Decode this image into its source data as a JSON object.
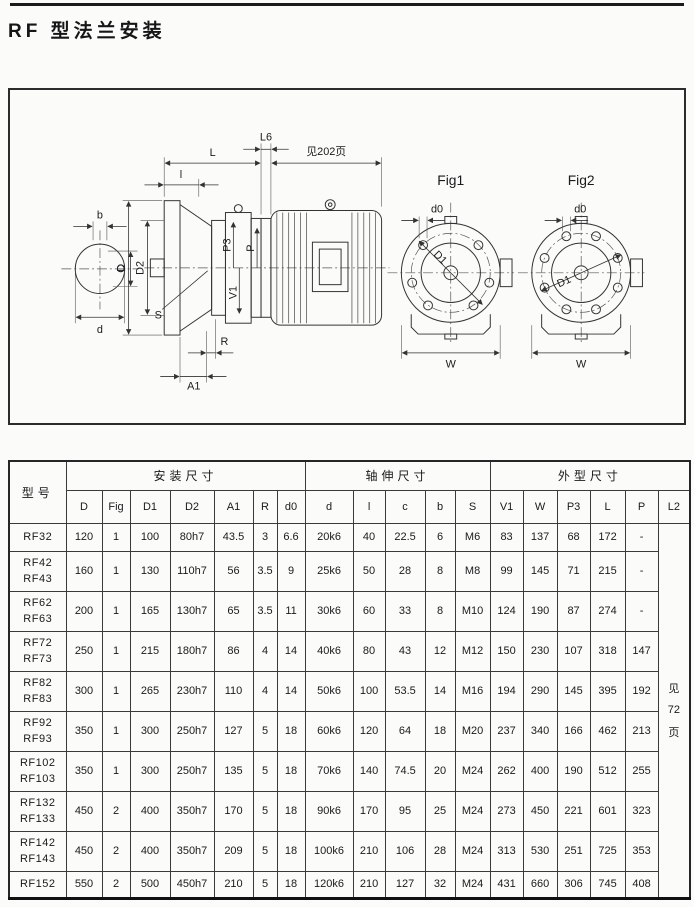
{
  "page": {
    "title": "RF 型法兰安装"
  },
  "drawing": {
    "labels": {
      "b": "b",
      "C": "C",
      "d_small": "d",
      "D": "D",
      "D2": "D2",
      "l_small": "l",
      "L": "L",
      "L6": "L6",
      "see_page": "见202页",
      "P3": "P3",
      "P": "P",
      "V1": "V1",
      "S": "S",
      "R": "R",
      "A1": "A1",
      "fig1": "Fig1",
      "fig2": "Fig2",
      "d0": "d0",
      "D1": "D1",
      "W": "W"
    }
  },
  "table": {
    "model_header": "型号",
    "groups": [
      {
        "label": "安装尺寸"
      },
      {
        "label": "轴伸尺寸"
      },
      {
        "label": "外型尺寸"
      }
    ],
    "columns": [
      "D",
      "Fig",
      "D1",
      "D2",
      "A1",
      "R",
      "d0",
      "d",
      "l",
      "c",
      "b",
      "S",
      "V1",
      "W",
      "P3",
      "L",
      "P",
      "L2"
    ],
    "l2_note_lines": [
      "见",
      "72",
      "页"
    ],
    "rows": [
      {
        "model": [
          "RF32"
        ],
        "values": [
          "120",
          "1",
          "100",
          "80h7",
          "43.5",
          "3",
          "6.6",
          "20k6",
          "40",
          "22.5",
          "6",
          "M6",
          "83",
          "137",
          "68",
          "172",
          "-"
        ]
      },
      {
        "model": [
          "RF42",
          "RF43"
        ],
        "values": [
          "160",
          "1",
          "130",
          "110h7",
          "56",
          "3.5",
          "9",
          "25k6",
          "50",
          "28",
          "8",
          "M8",
          "99",
          "145",
          "71",
          "215",
          "-"
        ]
      },
      {
        "model": [
          "RF62",
          "RF63"
        ],
        "values": [
          "200",
          "1",
          "165",
          "130h7",
          "65",
          "3.5",
          "11",
          "30k6",
          "60",
          "33",
          "8",
          "M10",
          "124",
          "190",
          "87",
          "274",
          "-"
        ]
      },
      {
        "model": [
          "RF72",
          "RF73"
        ],
        "values": [
          "250",
          "1",
          "215",
          "180h7",
          "86",
          "4",
          "14",
          "40k6",
          "80",
          "43",
          "12",
          "M12",
          "150",
          "230",
          "107",
          "318",
          "147"
        ]
      },
      {
        "model": [
          "RF82",
          "RF83"
        ],
        "values": [
          "300",
          "1",
          "265",
          "230h7",
          "110",
          "4",
          "14",
          "50k6",
          "100",
          "53.5",
          "14",
          "M16",
          "194",
          "290",
          "145",
          "395",
          "192"
        ]
      },
      {
        "model": [
          "RF92",
          "RF93"
        ],
        "values": [
          "350",
          "1",
          "300",
          "250h7",
          "127",
          "5",
          "18",
          "60k6",
          "120",
          "64",
          "18",
          "M20",
          "237",
          "340",
          "166",
          "462",
          "213"
        ]
      },
      {
        "model": [
          "RF102",
          "RF103"
        ],
        "values": [
          "350",
          "1",
          "300",
          "250h7",
          "135",
          "5",
          "18",
          "70k6",
          "140",
          "74.5",
          "20",
          "M24",
          "262",
          "400",
          "190",
          "512",
          "255"
        ]
      },
      {
        "model": [
          "RF132",
          "RF133"
        ],
        "values": [
          "450",
          "2",
          "400",
          "350h7",
          "170",
          "5",
          "18",
          "90k6",
          "170",
          "95",
          "25",
          "M24",
          "273",
          "450",
          "221",
          "601",
          "323"
        ]
      },
      {
        "model": [
          "RF142",
          "RF143"
        ],
        "values": [
          "450",
          "2",
          "400",
          "350h7",
          "209",
          "5",
          "18",
          "100k6",
          "210",
          "106",
          "28",
          "M24",
          "313",
          "530",
          "251",
          "725",
          "353"
        ]
      },
      {
        "model": [
          "RF152"
        ],
        "values": [
          "550",
          "2",
          "500",
          "450h7",
          "210",
          "5",
          "18",
          "120k6",
          "210",
          "127",
          "32",
          "M24",
          "431",
          "660",
          "306",
          "745",
          "408"
        ]
      }
    ]
  }
}
